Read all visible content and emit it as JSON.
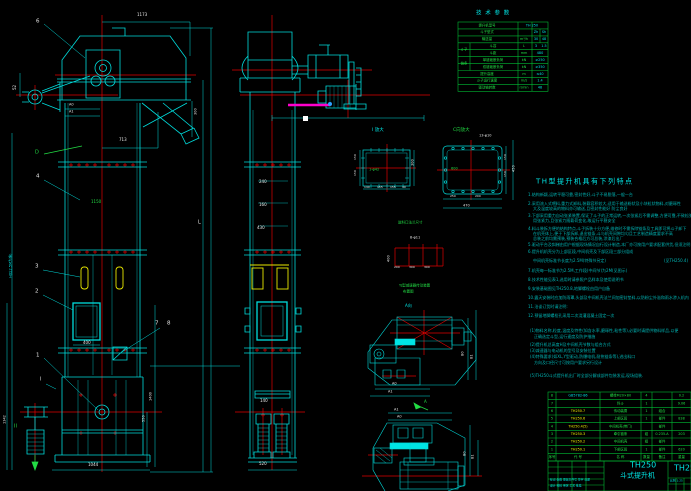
{
  "palette": {
    "w": "#e8e8e8",
    "c": "#00e5e5",
    "g": "#22dd44",
    "y": "#f0f000",
    "t": "#00b4b4",
    "r": "#ff3030"
  },
  "drawing_title": "TH250 斗式提升机",
  "tech_table": {
    "title": "技 术 参 数",
    "rows": [
      [
        {
          "t": "提升机型号",
          "cs": 2
        },
        {
          "t": "TH 250",
          "cs": 3,
          "c": "c"
        }
      ],
      [
        {
          "t": "斗子型式",
          "cs": 2
        },
        {
          "t": ""
        },
        {
          "t": "Zh",
          "c": "c"
        },
        {
          "t": "Sh",
          "c": "c"
        }
      ],
      [
        {
          "t": "输送量",
          "cs": 2
        },
        {
          "t": "m³/h"
        },
        {
          "t": "30",
          "c": "c"
        },
        {
          "t": "48",
          "c": "c"
        }
      ],
      [
        {
          "t": "斗子",
          "rs": 2
        },
        {
          "t": "斗容"
        },
        {
          "t": "L"
        },
        {
          "t": "3",
          "c": "c"
        },
        {
          "t": "1.5",
          "c": "c"
        }
      ],
      [
        {
          "t": ""
        },
        {
          "t": "斗距"
        },
        {
          "t": "mm"
        },
        {
          "t": "480",
          "cs": 2,
          "c": "c"
        }
      ],
      [
        {
          "t": "链条",
          "rs": 2
        },
        {
          "t": "单链破断负荷"
        },
        {
          "t": "kN"
        },
        {
          "t": "≥250",
          "cs": 2,
          "c": "c"
        }
      ],
      [
        {
          "t": ""
        },
        {
          "t": "双链破断负荷"
        },
        {
          "t": "kN"
        },
        {
          "t": "≥350",
          "cs": 2,
          "c": "c"
        }
      ],
      [
        {
          "t": "提升高度",
          "cs": 2
        },
        {
          "t": "m"
        },
        {
          "t": "≤40",
          "cs": 2,
          "c": "c"
        }
      ],
      [
        {
          "t": "斗子运行速度",
          "cs": 2
        },
        {
          "t": "m/s"
        },
        {
          "t": "1.4",
          "cs": 2,
          "c": "c"
        }
      ],
      [
        {
          "t": "驱动轴转数",
          "cs": 2
        },
        {
          "t": "r/min"
        },
        {
          "t": "48",
          "cs": 2,
          "c": "c"
        }
      ]
    ]
  },
  "bom": {
    "rows": [
      [
        {
          "t": "8",
          "c": "g"
        },
        {
          "t": "GB5782-86",
          "c": "c"
        },
        {
          "t": "螺栓M20×80",
          "c": "g"
        },
        {
          "t": "4",
          "c": "g"
        },
        {
          "t": ""
        },
        {
          "t": "0.2",
          "c": "g"
        }
      ],
      [
        {
          "t": "7",
          "c": "g"
        },
        {
          "t": ""
        },
        {
          "t": "料斗",
          "c": "g"
        },
        {
          "t": "1",
          "c": "g"
        },
        {
          "t": ""
        },
        {
          "t": "9.06",
          "c": "g"
        }
      ],
      [
        {
          "t": "6",
          "c": "g"
        },
        {
          "t": "TH250.7",
          "c": "y"
        },
        {
          "t": "传动装置",
          "c": "g"
        },
        {
          "t": "1",
          "c": "g"
        },
        {
          "t": "组合",
          "c": "g"
        },
        {
          "t": ""
        }
      ],
      [
        {
          "t": "5",
          "c": "g"
        },
        {
          "t": "TH250.6",
          "c": "y"
        },
        {
          "t": "上部区段",
          "c": "g"
        },
        {
          "t": "1",
          "c": "g"
        },
        {
          "t": "部件",
          "c": "g"
        },
        {
          "t": "838",
          "c": "g"
        }
      ],
      [
        {
          "t": "4",
          "c": "g"
        },
        {
          "t": "TH250.4(5)",
          "c": "y"
        },
        {
          "t": "中间机壳(带门)",
          "c": "g"
        },
        {
          "t": ""
        },
        {
          "t": "部件",
          "c": "g"
        },
        {
          "t": ""
        }
      ],
      [
        {
          "t": "3",
          "c": "g"
        },
        {
          "t": "TH250.3",
          "c": "y"
        },
        {
          "t": "牵引链条",
          "c": "g"
        },
        {
          "t": "组",
          "c": "g"
        },
        {
          "t": "0.235-A",
          "c": "g"
        },
        {
          "t": "203",
          "c": "g"
        }
      ],
      [
        {
          "t": "2",
          "c": "g"
        },
        {
          "t": "TH250.2",
          "c": "y"
        },
        {
          "t": "中间机壳",
          "c": "g"
        },
        {
          "t": "组",
          "c": "g"
        },
        {
          "t": "部件",
          "c": "g"
        },
        {
          "t": ""
        }
      ],
      [
        {
          "t": "1",
          "c": "g"
        },
        {
          "t": "TH250.1",
          "c": "y"
        },
        {
          "t": "下部区段",
          "c": "g"
        },
        {
          "t": "1",
          "c": "g"
        },
        {
          "t": "部件",
          "c": "g"
        },
        {
          "t": "620",
          "c": "g"
        }
      ],
      [
        {
          "t": "序号",
          "c": "g"
        },
        {
          "t": "代  号",
          "c": "g"
        },
        {
          "t": "名  称",
          "c": "g"
        },
        {
          "t": "数量",
          "c": "g"
        },
        {
          "t": "备注",
          "c": "g"
        },
        {
          "t": "重量",
          "c": "g"
        }
      ]
    ]
  },
  "notes": {
    "lines": [
      {
        "x": 536,
        "y": 178,
        "t": "TH型提升机具有下列特点",
        "c": "c",
        "s": 7,
        "ls": 1.5
      },
      {
        "x": 528,
        "y": 193,
        "t": "1.结构新颖,运转平稳可靠,密封性好,斗子不易脱落,一般一台"
      },
      {
        "x": 528,
        "y": 202,
        "t": "2.采用流入式喂料,重力式卸料,装载容积较大,适用于输送粉状及小块粒状物料,对磨琢性"
      },
      {
        "x": 533,
        "y": 207,
        "t": "大及温度较高的物料亦可输送,且密封性能好 防尘良好"
      },
      {
        "x": 528,
        "y": 214,
        "t": "3.下部采用重力自动张紧装置,保证了斗子的正常运转,一次张紧后不需调整,方便可靠,不致松弛"
      },
      {
        "x": 533,
        "y": 219,
        "t": "用张紧力,且张紧力随载荷变化,故运行平稳安全"
      },
      {
        "x": 528,
        "y": 227,
        "t": "4.料斗装拆方便的结构特点,斗子拆装十分方便,维修时不需拆除链条及工具即可将斗子卸下"
      },
      {
        "x": 533,
        "y": 232,
        "t": "在机壳体上,便于下部拆卸,退出链条,斗与机壳间隙均匀且工艺制造精度要求不高"
      },
      {
        "x": 533,
        "y": 237,
        "t": "总装之前均需预装,预装合格后方可总装,涂漆后出厂"
      },
      {
        "x": 528,
        "y": 243,
        "t": "5.驱动平台及斜梯由用户根据现场情况自行设计制造,本厂亦可按用户要求配套供货,但须注明"
      },
      {
        "x": 528,
        "y": 250,
        "t": "6.提升机机壳分为上部区段,中间机壳及下部区段三部分组成"
      },
      {
        "x": 533,
        "y": 259,
        "t": "中间机壳标准节长度为2.5M(特殊节另定)"
      },
      {
        "x": 664,
        "y": 259,
        "t": "(见TH250.4)"
      },
      {
        "x": 528,
        "y": 269,
        "t": "7.机壳每一标准节为2.5M,工作段(中间节)为2M(见图示)"
      },
      {
        "x": 528,
        "y": 278,
        "t": "8.技术性能见表1,选用时请参照产品样本及使用说明书"
      },
      {
        "x": 528,
        "y": 287,
        "t": "9.安装基础图见TH250.8,地脚螺栓由用户自备"
      },
      {
        "x": 528,
        "y": 296,
        "t": "10.露天安装时应加防雨罩,头部及中间机壳法兰间加密封垫料,以防粉尘外溢和雨水渗入机内"
      },
      {
        "x": 528,
        "y": 305,
        "t": "11.洽谈订货时请注明:"
      },
      {
        "x": 528,
        "y": 314,
        "t": "12.预留地脚螺栓孔采用二次浇灌混凝土固定一次"
      },
      {
        "x": 530,
        "y": 329,
        "t": "(1)物料名称,粒度,温度及特性(如含水率,磨琢性,粘性等),必要时请提供物料样品,以便"
      },
      {
        "x": 534,
        "y": 335,
        "t": "正确选定斗型,运行速度及防护措施"
      },
      {
        "x": 530,
        "y": 343,
        "t": "(2)提升机总高度H及中间机壳节数与组合方式"
      },
      {
        "x": 530,
        "y": 349,
        "t": "(3)减速器与电动机的型号及安装位置"
      },
      {
        "x": 530,
        "y": 355,
        "t": "(4)特殊要求(如XL,Y型驱动,防爆电机,耐热链条等),进出料口"
      },
      {
        "x": 534,
        "y": 361,
        "t": "方向及口径尺寸可按用户要求另行设计"
      },
      {
        "x": 530,
        "y": 374,
        "t": "(5)TH250斗式提升机出厂时全部分解成部件包装发运,现场组装."
      }
    ]
  },
  "annotations": [
    {
      "x": 137,
      "y": 13,
      "t": "1173"
    },
    {
      "x": 119,
      "y": 138,
      "t": "713"
    },
    {
      "x": 69,
      "y": 103,
      "t": "A0",
      "s": 3.5
    },
    {
      "x": 69,
      "y": 110,
      "t": "A1",
      "s": 3.5
    },
    {
      "x": 13,
      "y": 90,
      "t": "52",
      "r": 1
    },
    {
      "x": 83,
      "y": 341,
      "t": "400"
    },
    {
      "x": 88,
      "y": 463,
      "t": "1044"
    },
    {
      "x": 149,
      "y": 401,
      "t": "1400",
      "r": 1,
      "s": 3.5
    },
    {
      "x": 142,
      "y": 422,
      "t": "550",
      "r": 1,
      "s": 3.5
    },
    {
      "x": 3,
      "y": 424,
      "t": "1342",
      "r": 1,
      "s": 3.5
    },
    {
      "x": 9,
      "y": 278,
      "t": "H(以2.5M为准)",
      "r": 1,
      "c": "c",
      "s": 3.5
    },
    {
      "x": 198,
      "y": 220,
      "t": "L",
      "s": 5
    },
    {
      "x": 194,
      "y": 115,
      "t": "300",
      "r": 1,
      "s": 3.5
    },
    {
      "x": 36,
      "y": 18,
      "t": "6",
      "s": 5.5
    },
    {
      "x": 36,
      "y": 173,
      "t": "4",
      "s": 5.5
    },
    {
      "x": 35,
      "y": 263,
      "t": "3",
      "s": 5.5
    },
    {
      "x": 35,
      "y": 288,
      "t": "2",
      "s": 5.5
    },
    {
      "x": 36,
      "y": 352,
      "t": "1",
      "s": 5.5
    },
    {
      "x": 155,
      "y": 320,
      "t": "7",
      "s": 5.5
    },
    {
      "x": 167,
      "y": 320,
      "t": "8",
      "s": 5.5
    },
    {
      "x": 40,
      "y": 377,
      "t": "I",
      "s": 5
    },
    {
      "x": 14,
      "y": 424,
      "t": "II",
      "c": "g",
      "s": 5
    },
    {
      "x": 35,
      "y": 150,
      "t": "D",
      "c": "g",
      "s": 5
    },
    {
      "x": 91,
      "y": 200,
      "t": "1150",
      "c": "g"
    },
    {
      "x": 259,
      "y": 180,
      "t": "240"
    },
    {
      "x": 259,
      "y": 203,
      "t": "160"
    },
    {
      "x": 257,
      "y": 226,
      "t": "430"
    },
    {
      "x": 260,
      "y": 399,
      "t": "140"
    },
    {
      "x": 259,
      "y": 462,
      "t": "520"
    },
    {
      "x": 372,
      "y": 128,
      "t": "I 放大",
      "c": "c",
      "s": 4.5
    },
    {
      "x": 369,
      "y": 168,
      "t": "1-φ42",
      "c": "g",
      "s": 3.5
    },
    {
      "x": 411,
      "y": 166,
      "t": "300",
      "r": 1,
      "s": 3.5
    },
    {
      "x": 354,
      "y": 160,
      "t": "150",
      "r": 1,
      "s": 3
    },
    {
      "x": 354,
      "y": 176,
      "t": "150",
      "r": 1,
      "s": 3
    },
    {
      "x": 364,
      "y": 186,
      "t": "140",
      "s": 3
    },
    {
      "x": 377,
      "y": 186,
      "t": "155",
      "s": 3
    },
    {
      "x": 390,
      "y": 186,
      "t": "155",
      "s": 3
    },
    {
      "x": 402,
      "y": 186,
      "t": "30",
      "s": 3
    },
    {
      "x": 453,
      "y": 128,
      "t": "C向放大",
      "c": "g",
      "s": 4.5
    },
    {
      "x": 479,
      "y": 134,
      "t": "13-φ10",
      "s": 3.5
    },
    {
      "x": 451,
      "y": 167,
      "t": "600",
      "c": "g",
      "s": 3.5
    },
    {
      "x": 504,
      "y": 160,
      "t": "150",
      "r": 1,
      "s": 3
    },
    {
      "x": 504,
      "y": 177,
      "t": "150",
      "r": 1,
      "s": 3
    },
    {
      "x": 512,
      "y": 172,
      "t": "450",
      "r": 1,
      "s": 3.5
    },
    {
      "x": 450,
      "y": 195,
      "t": "250",
      "s": 3
    },
    {
      "x": 475,
      "y": 195,
      "t": "200",
      "s": 3
    },
    {
      "x": 463,
      "y": 204,
      "t": "470",
      "s": 3.5
    },
    {
      "x": 398,
      "y": 221,
      "t": "进料口法兰尺寸",
      "c": "g",
      "s": 3.5
    },
    {
      "x": 410,
      "y": 236,
      "t": "8-φ11",
      "s": 3.5
    },
    {
      "x": 387,
      "y": 262,
      "t": "400",
      "r": 1,
      "s": 3.5
    },
    {
      "x": 394,
      "y": 266,
      "t": "200",
      "s": 3
    },
    {
      "x": 409,
      "y": 266,
      "t": "300",
      "s": 3
    },
    {
      "x": 424,
      "y": 266,
      "t": "300",
      "s": 3
    },
    {
      "x": 399,
      "y": 284,
      "t": "YJ型减速器传动装置",
      "c": "g",
      "s": 3.5
    },
    {
      "x": 403,
      "y": 290,
      "t": "布置图",
      "c": "g",
      "s": 3.5
    },
    {
      "x": 405,
      "y": 304,
      "t": "A向",
      "c": "c",
      "s": 4
    },
    {
      "x": 461,
      "y": 356,
      "t": "B0",
      "r": 1,
      "s": 3.5
    },
    {
      "x": 470,
      "y": 359,
      "t": "B1",
      "r": 1,
      "s": 3.5
    },
    {
      "x": 392,
      "y": 382,
      "t": "A0",
      "s": 3.5
    },
    {
      "x": 388,
      "y": 390,
      "t": "A1",
      "s": 3.5
    },
    {
      "x": 394,
      "y": 408,
      "t": "A1",
      "s": 3.5
    },
    {
      "x": 397,
      "y": 415,
      "t": "A0",
      "s": 3.5
    },
    {
      "x": 424,
      "y": 400,
      "t": "A",
      "c": "g",
      "s": 4
    },
    {
      "x": 463,
      "y": 456,
      "t": "B0",
      "r": 1,
      "s": 3.5
    },
    {
      "x": 471,
      "y": 459,
      "t": "B1",
      "r": 1,
      "s": 3.5
    },
    {
      "x": 476,
      "y": 10,
      "t": "技 术 参 数",
      "c": "c",
      "s": 5.5,
      "ls": 1
    },
    {
      "x": 630,
      "y": 461,
      "t": "TH250",
      "c": "c",
      "s": 8
    },
    {
      "x": 620,
      "y": 472,
      "t": "斗式提升机",
      "c": "c",
      "s": 7
    },
    {
      "x": 674,
      "y": 464,
      "t": "TH250",
      "c": "c",
      "s": 8
    },
    {
      "x": 550,
      "y": 479,
      "t": "标记 处数 更改文件号 签字 日期",
      "c": "c",
      "s": 2.8
    },
    {
      "x": 550,
      "y": 485,
      "t": "设计  校核  审定  工艺  批准",
      "c": "c",
      "s": 2.8
    },
    {
      "x": 670,
      "y": 480,
      "t": "比例 1:25",
      "c": "c",
      "s": 2.8
    }
  ]
}
